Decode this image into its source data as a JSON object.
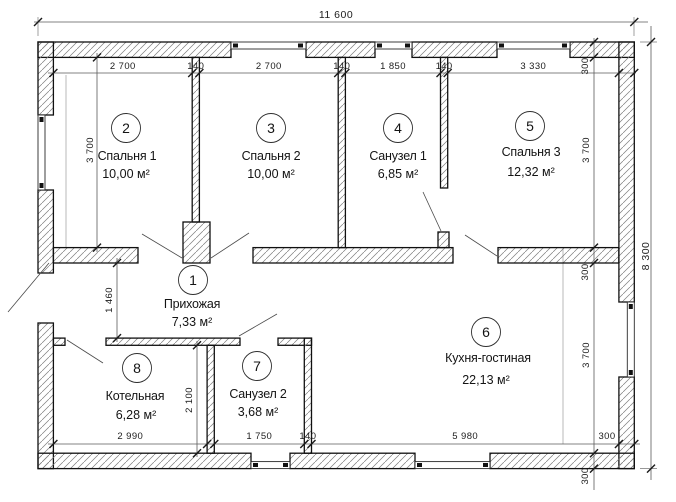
{
  "drawing": {
    "type": "floor-plan",
    "line_color": "#101010",
    "background_color": "#ffffff",
    "dims": {
      "overall_width": "11 600",
      "overall_height": "8 300",
      "top_row": [
        "2 700",
        "140",
        "2 700",
        "140",
        "1 850",
        "140",
        "3 330"
      ],
      "right_chain": [
        "300",
        "3 700",
        "300",
        "3 700",
        "300"
      ],
      "bottom_row": [
        "2 990",
        "1 750",
        "140",
        "5 980",
        "300"
      ],
      "left_chain": [
        "3 700"
      ],
      "hallway_depth": "1 460",
      "boiler_depth": "2 100"
    },
    "rooms": [
      {
        "number": "1",
        "name": "Прихожая",
        "area": "7,33 м²"
      },
      {
        "number": "2",
        "name": "Спальня 1",
        "area": "10,00 м²"
      },
      {
        "number": "3",
        "name": "Спальня 2",
        "area": "10,00 м²"
      },
      {
        "number": "4",
        "name": "Санузел 1",
        "area": "6,85 м²"
      },
      {
        "number": "5",
        "name": "Спальня 3",
        "area": "12,32 м²"
      },
      {
        "number": "6",
        "name": "Кухня-гостиная",
        "area": "22,13 м²"
      },
      {
        "number": "7",
        "name": "Санузел 2",
        "area": "3,68 м²"
      },
      {
        "number": "8",
        "name": "Котельная",
        "area": "6,28 м²"
      }
    ]
  }
}
